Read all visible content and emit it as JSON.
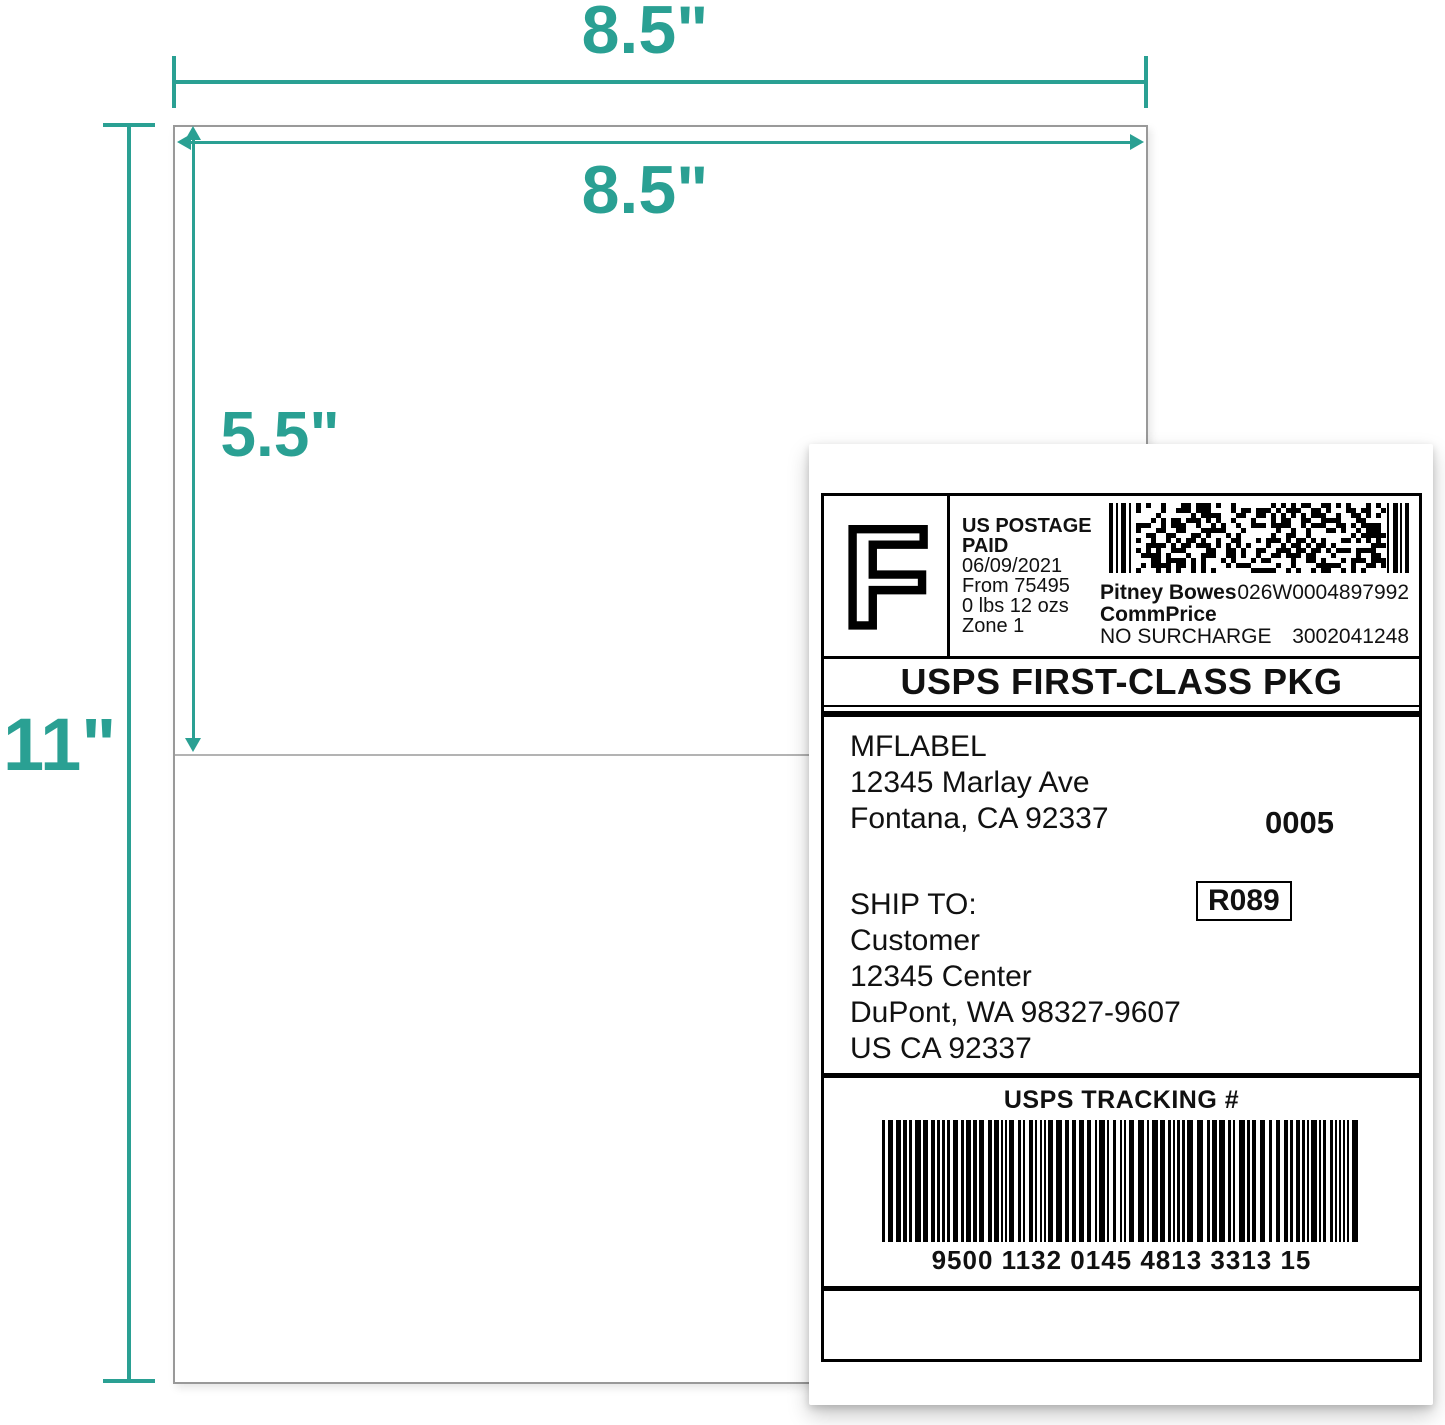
{
  "colors": {
    "accent": "#2aa093"
  },
  "dimensions": {
    "top_width": "8.5\"",
    "inner_width": "8.5\"",
    "half_height": "5.5\"",
    "full_height": "11\""
  },
  "label": {
    "postage": {
      "indicia_letter": "F",
      "line1": "US POSTAGE",
      "line2": "PAID",
      "date": "06/09/2021",
      "origin": "From 75495",
      "weight": "0 lbs 12 ozs",
      "zone": "Zone 1",
      "carrier": "Pitney Bowes",
      "rate_plan": "CommPrice",
      "surcharge": "NO SURCHARGE",
      "meter_number": "026W0004897992",
      "serial_number": "3002041248"
    },
    "service": "USPS FIRST-CLASS PKG",
    "from_address": {
      "name": "MFLABEL",
      "street": "12345 Marlay Ave",
      "city_line": "Fontana, CA 92337"
    },
    "batch_number": "0005",
    "ship_to_label": "SHIP TO:",
    "to_address": {
      "name": "Customer",
      "street": "12345 Center",
      "city_line": "DuPont, WA 98327-9607",
      "country_line": "US CA 92337"
    },
    "route_code": "R089",
    "tracking_header": "USPS TRACKING #",
    "tracking_number": "9500 1132 0145 4813 3313 15"
  }
}
